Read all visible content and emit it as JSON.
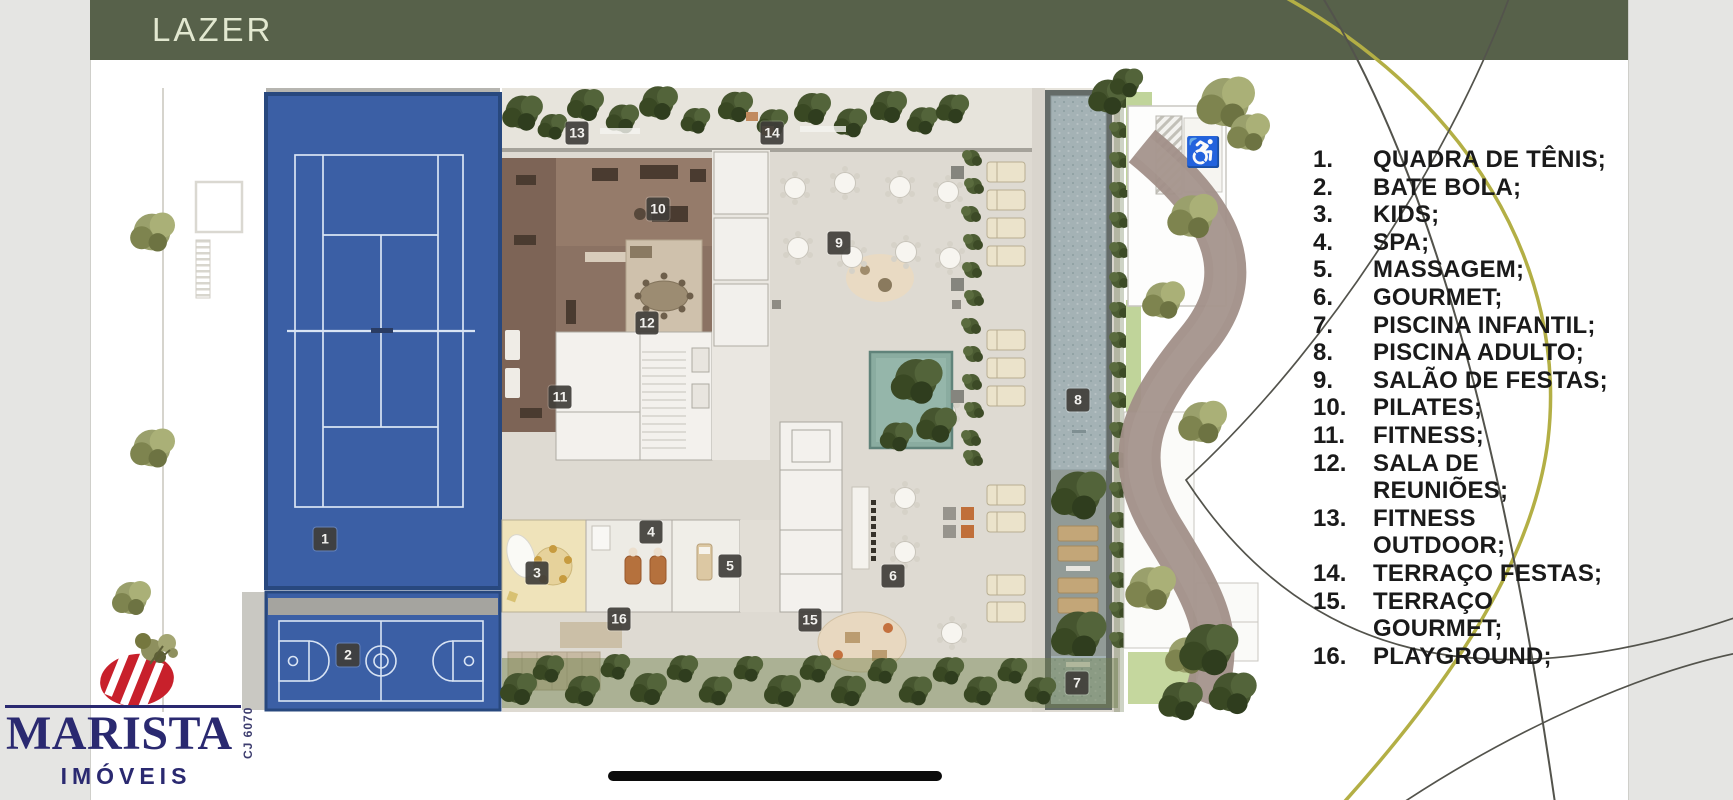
{
  "header": {
    "title": "LAZER"
  },
  "legend": {
    "items": [
      {
        "num": "1.",
        "lines": [
          "QUADRA DE TÊNIS;"
        ]
      },
      {
        "num": "2.",
        "lines": [
          "BATE BOLA;"
        ]
      },
      {
        "num": "3.",
        "lines": [
          "KIDS;"
        ]
      },
      {
        "num": "4.",
        "lines": [
          "SPA;"
        ]
      },
      {
        "num": "5.",
        "lines": [
          "MASSAGEM;"
        ]
      },
      {
        "num": "6.",
        "lines": [
          "GOURMET;"
        ]
      },
      {
        "num": "7.",
        "lines": [
          "PISCINA INFANTIL;"
        ]
      },
      {
        "num": "8.",
        "lines": [
          "PISCINA ADULTO;"
        ]
      },
      {
        "num": "9.",
        "lines": [
          "SALÃO DE FESTAS;"
        ]
      },
      {
        "num": "10.",
        "lines": [
          "PILATES;"
        ]
      },
      {
        "num": "11.",
        "lines": [
          "FITNESS;"
        ]
      },
      {
        "num": "12.",
        "lines": [
          "SALA DE",
          "REUNIÕES;"
        ]
      },
      {
        "num": "13.",
        "lines": [
          "FITNESS",
          "OUTDOOR;"
        ]
      },
      {
        "num": "14.",
        "lines": [
          "TERRAÇO FESTAS;"
        ]
      },
      {
        "num": "15.",
        "lines": [
          "TERRAÇO",
          "GOURMET;"
        ]
      },
      {
        "num": "16.",
        "lines": [
          "PLAYGROUND;"
        ]
      }
    ]
  },
  "plan": {
    "accessibility_icon": "♿",
    "markers": [
      {
        "n": "1",
        "x": 325,
        "y": 539
      },
      {
        "n": "2",
        "x": 348,
        "y": 655
      },
      {
        "n": "3",
        "x": 537,
        "y": 573
      },
      {
        "n": "4",
        "x": 651,
        "y": 532
      },
      {
        "n": "5",
        "x": 730,
        "y": 566
      },
      {
        "n": "6",
        "x": 893,
        "y": 576
      },
      {
        "n": "7",
        "x": 1077,
        "y": 683
      },
      {
        "n": "8",
        "x": 1078,
        "y": 400
      },
      {
        "n": "9",
        "x": 839,
        "y": 243
      },
      {
        "n": "10",
        "x": 658,
        "y": 209
      },
      {
        "n": "11",
        "x": 560,
        "y": 397
      },
      {
        "n": "12",
        "x": 647,
        "y": 323
      },
      {
        "n": "13",
        "x": 577,
        "y": 133
      },
      {
        "n": "14",
        "x": 772,
        "y": 133
      },
      {
        "n": "15",
        "x": 810,
        "y": 620
      },
      {
        "n": "16",
        "x": 619,
        "y": 619
      }
    ]
  },
  "logo": {
    "name": "MARISTA",
    "subtitle": "IMÓVEIS",
    "registration": "CJ 6070"
  },
  "colors": {
    "olive": "#57614a",
    "navy": "#2a2970",
    "red": "#c8202b",
    "courtblue": "#3b5fa5",
    "arcolive": "#b3af45"
  }
}
